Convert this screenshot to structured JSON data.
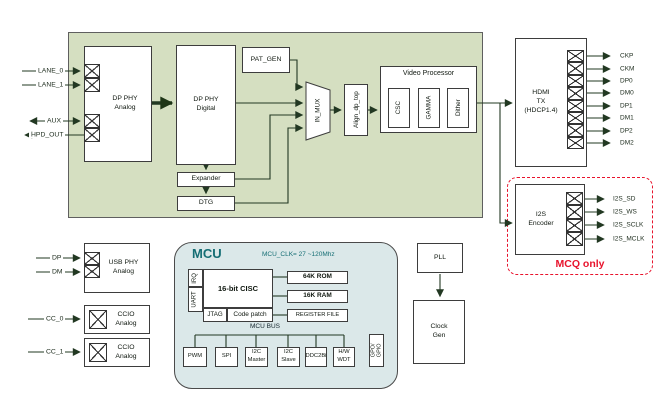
{
  "signals": {
    "dp_inputs": {
      "lane0": "LANE_0",
      "lane1": "LANE_1",
      "aux": "AUX",
      "hpd_out": "HPD_OUT"
    },
    "usb_inputs": {
      "dp": "DP",
      "dm": "DM"
    },
    "cc_inputs": {
      "cc0": "CC_0",
      "cc1": "CC_1"
    },
    "hdmi_outputs": [
      "CKP",
      "CKM",
      "DP0",
      "DM0",
      "DP1",
      "DM1",
      "DP2",
      "DM2"
    ],
    "i2s_outputs": [
      "I2S_SD",
      "I2S_WS",
      "I2S_SCLK",
      "I2S_MCLK"
    ]
  },
  "blocks": {
    "dp_phy_analog": "DP PHY\nAnalog",
    "dp_phy_digital": "DP PHY\nDigital",
    "pat_gen": "PAT_GEN",
    "in_mux": "IN_MUX",
    "align_dp_top": "Align_dp_top",
    "video_processor": "Video Processor",
    "csc": "CSC",
    "gamma": "GAMMA",
    "dither": "Dither",
    "expander": "Expander",
    "dtg": "DTG",
    "hdmi_tx": "HDMI\nTX\n(HDCP1.4)",
    "i2s_encoder": "I2S\nEncoder",
    "mcq_only": "MCQ only",
    "usb_phy_analog": "USB PHY\nAnalog",
    "ccio_analog_0": "CCIO\nAnalog",
    "ccio_analog_1": "CCIO\nAnalog",
    "pll": "PLL",
    "clock_gen": "Clock\nGen"
  },
  "mcu": {
    "title": "MCU",
    "clock_note": "MCU_CLK= 27 ~120Mhz",
    "irq": "IRQ",
    "uart": "UART",
    "cisc": "16-bit CISC",
    "jtag": "JTAG",
    "code_patch": "Code patch",
    "rom": "64K ROM",
    "ram": "16K RAM",
    "register_file": "REGISTER FILE",
    "bus_label": "MCU BUS",
    "peripherals": [
      "PWM",
      "SPI",
      "I2C\nMaster",
      "I2C\nSlave",
      "DDC2Bi",
      "H/W\nWDT"
    ],
    "gpo": "GPO/\nGPIO"
  },
  "colors": {
    "container_green": "#d5dfc1",
    "mcu_fill": "#dbe8e9",
    "teal_text": "#156e74",
    "red_accent": "#e8132c",
    "line": "#223822"
  }
}
